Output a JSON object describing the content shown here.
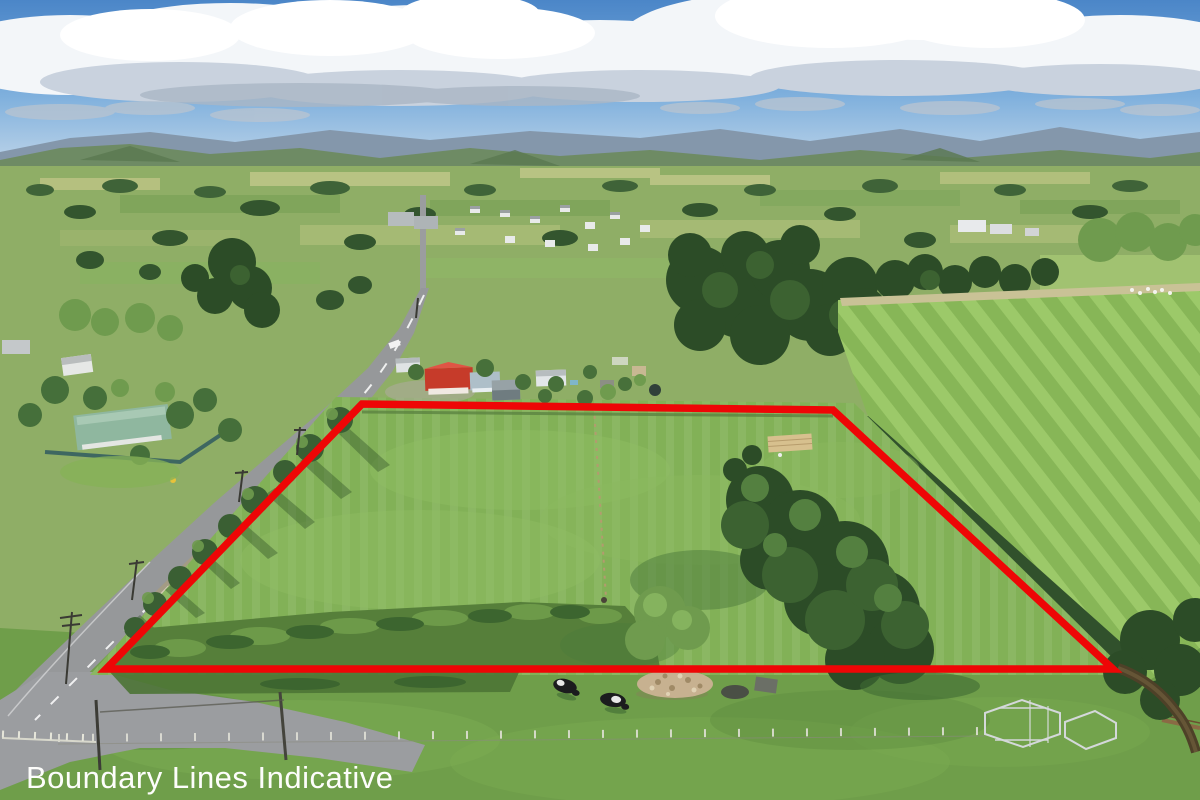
{
  "photo": {
    "caption": "Boundary Lines Indicative",
    "caption_color": "#fdfdfb"
  },
  "boundary": {
    "color": "#ee0606",
    "stroke_width": "7.5",
    "points": "362,404 833,410 1113,669 106,669"
  },
  "palette": {
    "sky_top": "#4b86c8",
    "sky_mid": "#7fb0dd",
    "sky_horizon": "#c6d9ea",
    "cloud": "#f3f6f9",
    "cloud_shadow": "#c9d2de",
    "hills_far": "#8497ab",
    "hills_near": "#6d8a60",
    "farmland": "#8fae66",
    "paddock": "#82b157",
    "striped_base": "#87b657",
    "striped_stripe": "#9cc969",
    "trees_dark": "#2c4c27",
    "trees_mid": "#3c6231",
    "trees_light": "#6f9b4e",
    "road": "#96989a",
    "reeds": "#567f3a",
    "foreground": "#6f9e4a",
    "red_roof": "#c63b2a",
    "rock_pile": "#c7b190",
    "cow_black": "#1b1c1e",
    "yards_steel": "#d4d8da",
    "stream_brown": "#4e4128"
  }
}
